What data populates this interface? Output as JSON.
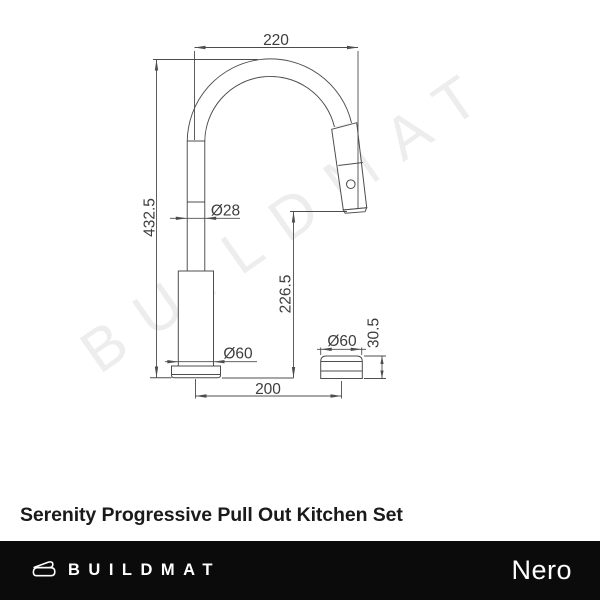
{
  "watermark": {
    "text": "BUILDMAT"
  },
  "drawing": {
    "dims": {
      "top_width": "220",
      "total_height": "432.5",
      "spout_diameter": "Ø28",
      "outlet_height": "226.5",
      "body_diameter": "Ø60",
      "spacing": "200",
      "control_diameter": "Ø60",
      "control_height": "30.5"
    },
    "line_color": "#4d4d4d"
  },
  "title": "Serenity Progressive Pull Out Kitchen Set",
  "footer": {
    "brand": "BUILDMAT",
    "brand_right": "Nero",
    "background": "#0b0b0b"
  }
}
